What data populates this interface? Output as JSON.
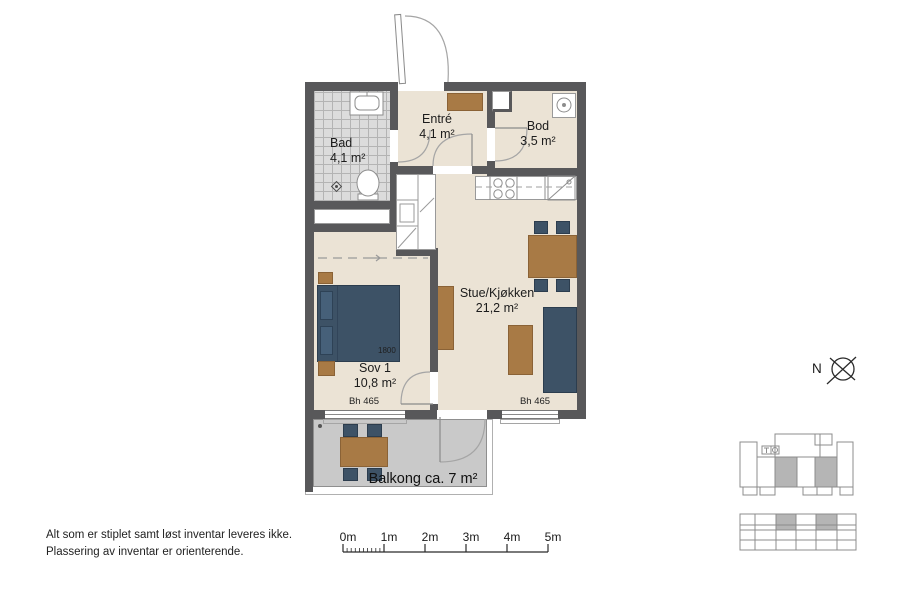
{
  "plan": {
    "rooms": {
      "bad": {
        "name": "Bad",
        "area": "4,1 m²"
      },
      "entre": {
        "name": "Entré",
        "area": "4,1 m²"
      },
      "bod": {
        "name": "Bod",
        "area": "3,5 m²"
      },
      "stue": {
        "name": "Stue/Kjøkken",
        "area": "21,2 m²"
      },
      "sov1": {
        "name": "Sov 1",
        "area": "10,8 m²"
      },
      "balkong": {
        "label": "Balkong ca. 7 m²"
      }
    },
    "dimensions": {
      "bed_width": "1800",
      "window_left": "Bh 465",
      "window_right": "Bh 465"
    },
    "compass": {
      "label": "N"
    }
  },
  "scalebar": {
    "labels": [
      "0m",
      "1m",
      "2m",
      "3m",
      "4m",
      "5m"
    ]
  },
  "notes": {
    "line1": "Alt som er stiplet samt løst inventar leveres ikke.",
    "line2": "Plassering av inventar er orienterende."
  },
  "colors": {
    "wall": "#58585a",
    "floor": "#ebe3d5",
    "tile": "#dcdcdc",
    "balcony": "#c9c9c9",
    "furniture_wood": "#a87a45",
    "furniture_blue": "#3d5266",
    "minimap_highlight": "#b5b5b5"
  }
}
